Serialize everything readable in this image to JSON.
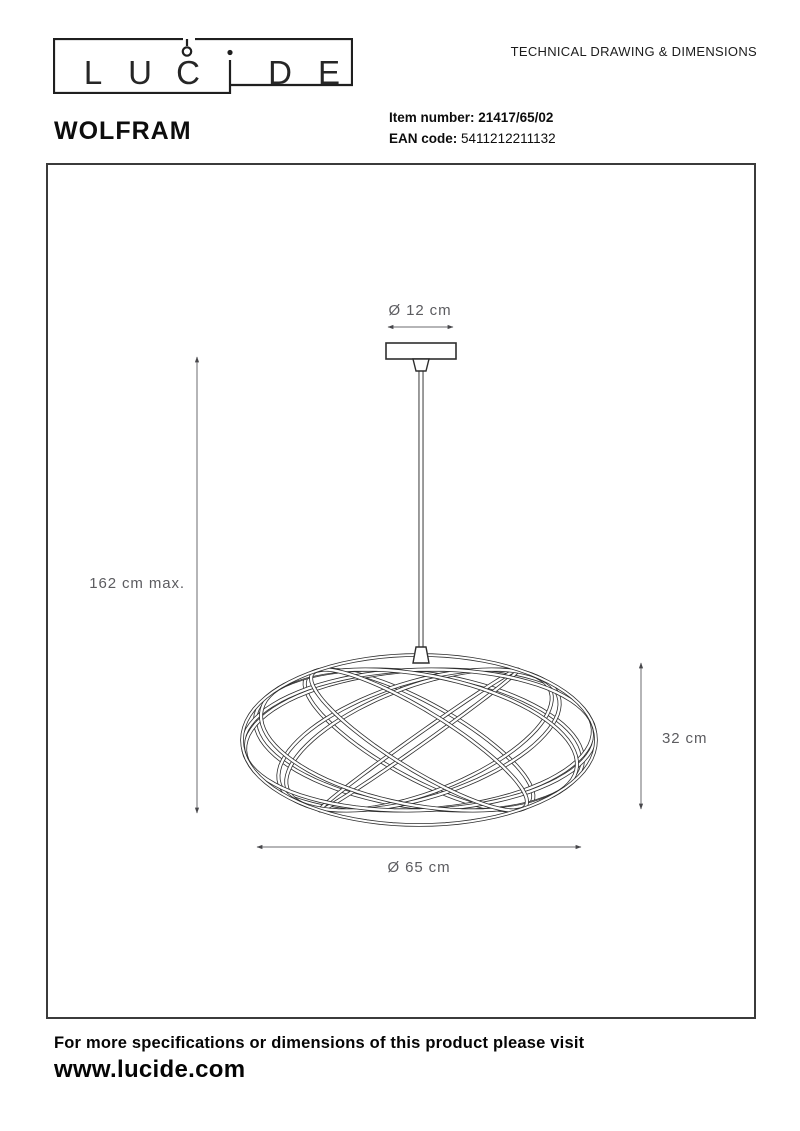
{
  "logo": {
    "brand": "LUCIDE",
    "letters": [
      "L",
      "U",
      "C",
      "D",
      "E"
    ]
  },
  "header": {
    "title": "TECHNICAL DRAWING & DIMENSIONS"
  },
  "product": {
    "name": "WOLFRAM",
    "item_label": "Item number:",
    "item_value": "21417/65/02",
    "ean_label": "EAN code:",
    "ean_value": "5411212211132"
  },
  "drawing": {
    "canopy_diameter": "Ø 12 cm",
    "max_height": "162 cm max.",
    "shade_height": "32 cm",
    "shade_diameter": "Ø 65 cm"
  },
  "footer": {
    "line1": "For more specifications or dimensions of this product please visit",
    "line2": "www.lucide.com"
  },
  "colors": {
    "ink": "#1a1a1a",
    "stroke": "#2e2e2e",
    "dim": "#5c5c60",
    "frame": "#3b3b3b"
  }
}
